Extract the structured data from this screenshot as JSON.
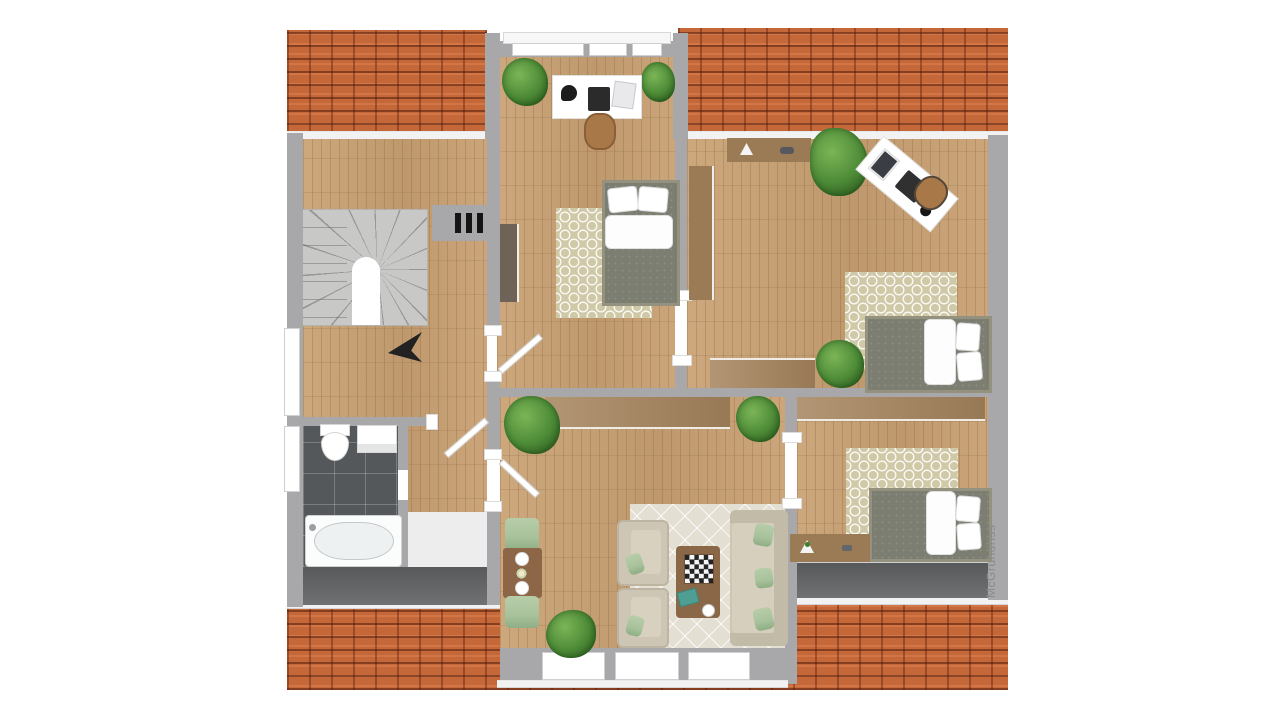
{
  "watermark": {
    "text": "McGrundriss"
  },
  "palette": {
    "roof": "#c4683a",
    "roofdark": "#7c2e11",
    "wall": "#a8a8aa",
    "wood": "#c9a173",
    "tile": "#55585b",
    "balcony": "#66686a",
    "stairs": "#c8c8c6",
    "rug": "#cfc9a8",
    "rugcream": "#e4dfd3",
    "sofa": "#cdc6b4",
    "sage": "#a8c29c",
    "tablewood": "#8d6648",
    "coffeetable": "#8a6747",
    "sideboard": "#a5835c",
    "sideboarddark": "#9b7b55",
    "wardrobedark": "#6f6257",
    "plant": "#4c8a36",
    "plantdark": "#2e5d20",
    "mattress": "#7c7e72",
    "bedframe": "#94917f",
    "chairwood": "#a87848",
    "watermark": "#8a8a8a"
  },
  "furnishings": {
    "hall": [
      "staircase",
      "stair-direction-arrow",
      "radiator"
    ],
    "bathroom": [
      "toilet",
      "washbasin",
      "bathtub"
    ],
    "bedroom_top": [
      "desk",
      "monitor",
      "desk-lamp",
      "desk-chair",
      "wardrobe",
      "single-bed",
      "rug",
      "plant"
    ],
    "bedroom_right": [
      "sideboard",
      "wardrobe",
      "rotated-desk",
      "laptop",
      "desk-chair",
      "single-bed",
      "rug",
      "plant"
    ],
    "bedroom_bottom_right": [
      "sideboard",
      "desk",
      "single-bed",
      "rug"
    ],
    "living_room": [
      "sideboard",
      "dining-table",
      "dining-chairs",
      "armchairs",
      "sofa",
      "coffee-table",
      "chessboard",
      "rug",
      "plant"
    ],
    "exterior": [
      "roof-tiles",
      "balcony",
      "windows",
      "dormer"
    ]
  }
}
